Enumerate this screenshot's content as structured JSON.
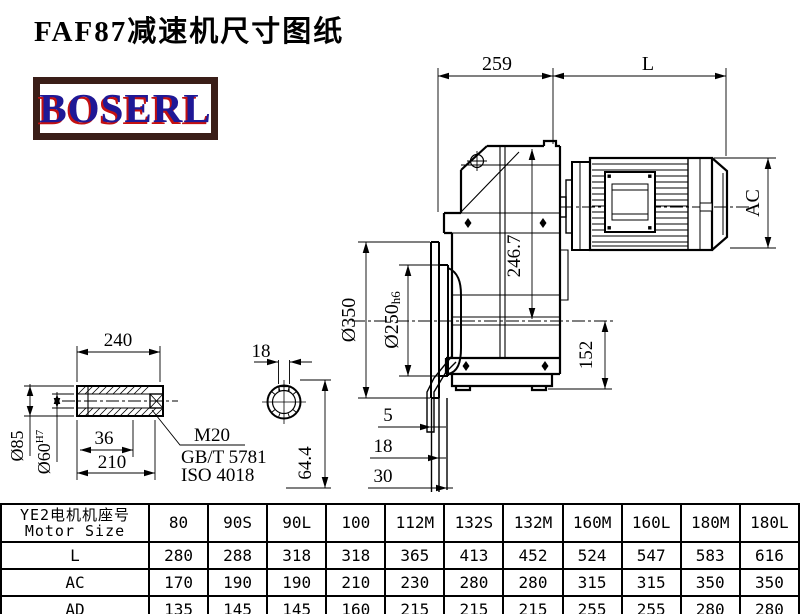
{
  "title": "FAF87减速机尺寸图纸",
  "logo": {
    "text": "BOSERL",
    "text_color": "#1f1896",
    "accent_color": "#c41111",
    "border_color": "#3a1e18"
  },
  "drawing": {
    "line_color": "#000000",
    "dims": {
      "d259": "259",
      "dL": "L",
      "dAC": "AC",
      "d2467": "246.7",
      "d152": "152",
      "d350": "Ø350",
      "d250": "Ø250",
      "d250tol": "h6",
      "s5": "5",
      "s18": "18",
      "s30": "30"
    },
    "shaft_detail": {
      "d240": "240",
      "d85": "Ø85",
      "d60": "Ø60",
      "d60tol": "H7",
      "d36": "36",
      "d210": "210",
      "thread": "M20",
      "standard1": "GB/T 5781",
      "standard2": "ISO 4018",
      "key_width": "18",
      "key_height": "64.4"
    }
  },
  "table": {
    "header_cn": "YE2电机机座号",
    "header_en": "Motor Size",
    "columns": [
      "80",
      "90S",
      "90L",
      "100",
      "112M",
      "132S",
      "132M",
      "160M",
      "160L",
      "180M",
      "180L"
    ],
    "rows": [
      {
        "label": "L",
        "values": [
          "280",
          "288",
          "318",
          "318",
          "365",
          "413",
          "452",
          "524",
          "547",
          "583",
          "616"
        ]
      },
      {
        "label": "AC",
        "values": [
          "170",
          "190",
          "190",
          "210",
          "230",
          "280",
          "280",
          "315",
          "315",
          "350",
          "350"
        ]
      },
      {
        "label": "AD",
        "values": [
          "135",
          "145",
          "145",
          "160",
          "215",
          "215",
          "215",
          "255",
          "255",
          "280",
          "280"
        ]
      }
    ]
  }
}
